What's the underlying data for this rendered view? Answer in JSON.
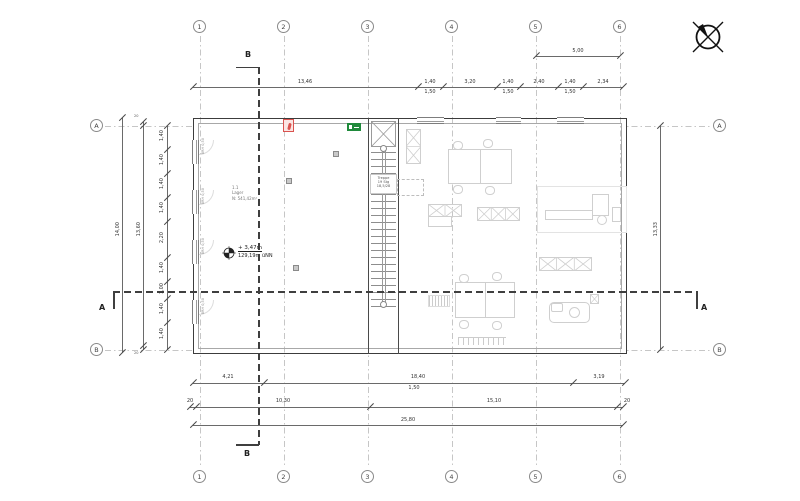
{
  "title": "Grundriss Obergeschoss – Lager (CAD-Plan)",
  "colors": {
    "accent_red": "#d9534f",
    "accent_green": "#1f8a3b",
    "line_dark": "#3c3c3c",
    "line_light": "#c6c6c6"
  },
  "icons": {
    "north": "north-arrow-icon",
    "fire": "fire-extinguisher-icon",
    "exit": "emergency-exit-icon",
    "level": "level-marker-icon"
  },
  "grid": {
    "cols": [
      "1",
      "2",
      "3",
      "4",
      "5",
      "6"
    ],
    "rows": [
      "A",
      "B"
    ]
  },
  "sections": {
    "a": "A",
    "b": "B"
  },
  "dims": {
    "top2": "5,00",
    "top": [
      "13,46",
      "1,40",
      "3,20",
      "1,40",
      "2,40",
      "1,40",
      "2,34"
    ],
    "top_sub": [
      "1,50",
      "1,50",
      "1,50"
    ],
    "b1": [
      "4,21",
      "18,40",
      "3,19"
    ],
    "b1_sub": "1,50",
    "b2": [
      "20",
      "10,30",
      "15,10",
      "20"
    ],
    "b3": "25,80",
    "left_outer": "14,00",
    "left_mid": "13,60",
    "left_caps": [
      "20",
      "20"
    ],
    "left_inner": [
      "1,40",
      "1,40",
      "1,40",
      "1,40",
      "2,20",
      "1,40",
      "1,00",
      "1,40",
      "1,40"
    ],
    "right_outer": "13,33"
  },
  "room": {
    "id": "1.1",
    "name": "Lager",
    "area": "N: 541,42m²"
  },
  "level": {
    "elevation": "+ 3,47m",
    "datum": "129,19m üNN"
  },
  "stair": {
    "l1": "Treppe",
    "l2": "19 Stg",
    "l3": "18,5/28"
  },
  "labels": {
    "brh": "BRH 0,50"
  }
}
